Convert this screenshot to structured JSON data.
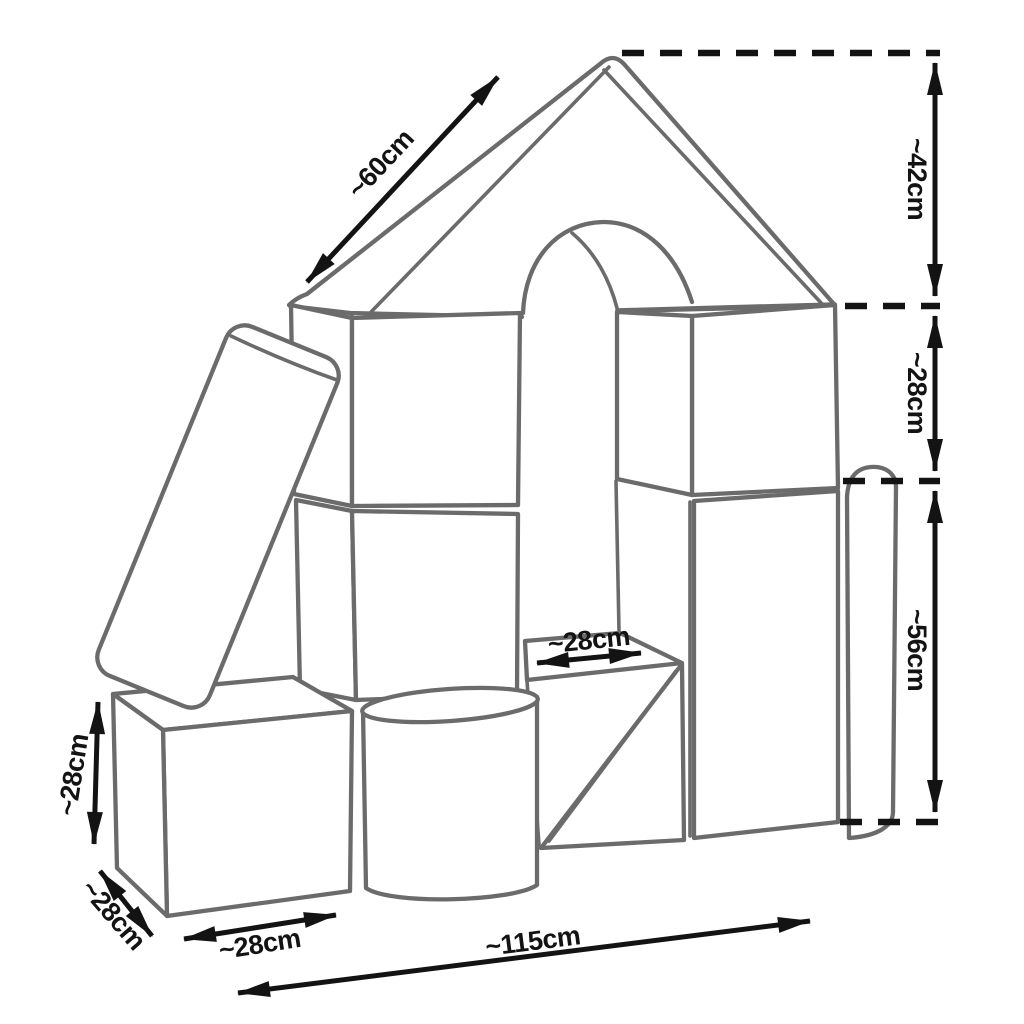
{
  "page": {
    "background": "#ffffff"
  },
  "diagram": {
    "subject": "foam-building-blocks-house-dimension-diagram",
    "outline_color": "#6b6b6b",
    "dimension_color": "#131313",
    "labels": {
      "roof_slope_length": "~60cm",
      "roof_height": "~42cm",
      "upper_right_height": "~28cm",
      "lower_right_height": "~56cm",
      "step_depth": "~28cm",
      "cube_height": "~28cm",
      "cube_depth": "~28cm",
      "cube_width": "~28cm",
      "total_width": "~115cm"
    }
  }
}
